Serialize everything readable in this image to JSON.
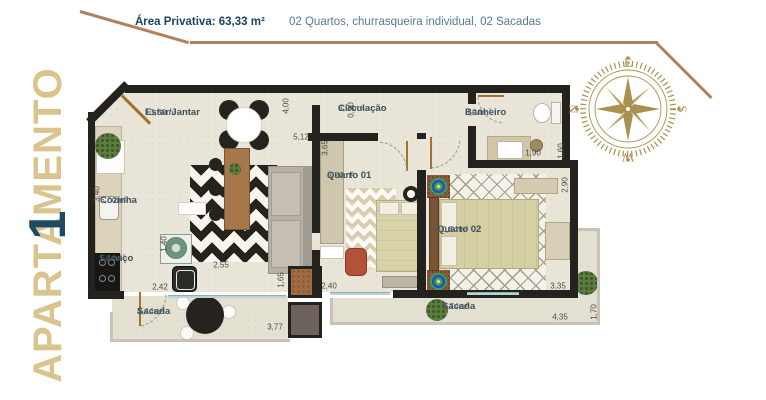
{
  "header": {
    "area_label": "Área Privativa: 63,33 m²",
    "features": "02 Quartos, churrasqueira individual, 02 Sacadas"
  },
  "title": {
    "word": "APARTAMENTO",
    "number": "1"
  },
  "compass": {
    "points": [
      "E",
      "S",
      "W",
      "N"
    ]
  },
  "rooms": [
    {
      "name": "Estar/Jantar",
      "area": "13,30m²"
    },
    {
      "name": "Cozinha",
      "area": "6,00m²"
    },
    {
      "name": "Serviço",
      "area": "1,74m²"
    },
    {
      "name": "Sacada",
      "area": "4,44m²"
    },
    {
      "name": "Circulação",
      "area": "3,04m²"
    },
    {
      "name": "Banheiro",
      "area": "3,04m²"
    },
    {
      "name": "Quarto 01",
      "area": "8,76m²"
    },
    {
      "name": "Quarto 02",
      "area": "10,54m²"
    },
    {
      "name": "Sacada",
      "area": "3,74m²"
    }
  ],
  "dimensions": [
    {
      "value": "4,00",
      "x": 286,
      "y": 106,
      "v": 1
    },
    {
      "value": "5,12",
      "x": 301,
      "y": 137,
      "v": 0
    },
    {
      "value": "3,65",
      "x": 325,
      "y": 148,
      "v": 1
    },
    {
      "value": "0,90",
      "x": 351,
      "y": 110,
      "v": 1
    },
    {
      "value": "1,90",
      "x": 533,
      "y": 153,
      "v": 0
    },
    {
      "value": "1,60",
      "x": 561,
      "y": 151,
      "v": 1
    },
    {
      "value": "2,90",
      "x": 565,
      "y": 185,
      "v": 1
    },
    {
      "value": "3,40",
      "x": 97,
      "y": 194,
      "v": 1
    },
    {
      "value": "1,40",
      "x": 164,
      "y": 244,
      "v": 1
    },
    {
      "value": "2,55",
      "x": 221,
      "y": 265,
      "v": 0
    },
    {
      "value": "2,42",
      "x": 160,
      "y": 287,
      "v": 0
    },
    {
      "value": "1,65",
      "x": 281,
      "y": 280,
      "v": 1
    },
    {
      "value": "2,40",
      "x": 329,
      "y": 286,
      "v": 0
    },
    {
      "value": "3,77",
      "x": 275,
      "y": 327,
      "v": 0
    },
    {
      "value": "3,35",
      "x": 558,
      "y": 286,
      "v": 0
    },
    {
      "value": "4,35",
      "x": 560,
      "y": 317,
      "v": 0
    },
    {
      "value": "1,70",
      "x": 594,
      "y": 312,
      "v": 1
    }
  ],
  "colors": {
    "accent_gold": "#b0815a",
    "title_gold": "#d9c48e",
    "title_navy": "#1d4a61",
    "header_navy": "#17465f",
    "header_blue": "#577b90",
    "wall": "#24221f",
    "floor": "#e9e5d8"
  }
}
